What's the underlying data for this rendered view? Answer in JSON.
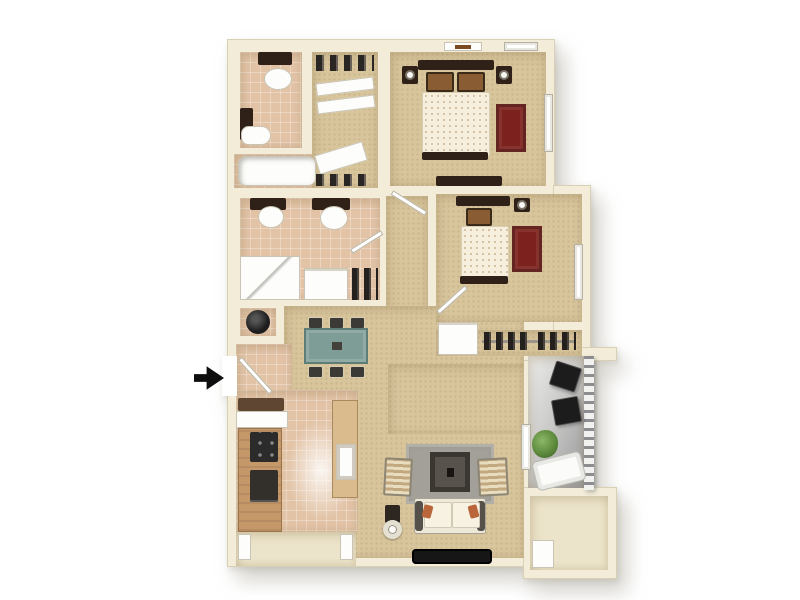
{
  "figure": {
    "kind": "3d-floorplan-rendering",
    "entry_indicator": "black-right-arrow-icon",
    "background": "#ffffff"
  },
  "colors": {
    "wall": "#f2ecd8",
    "wall-edge": "#d8d0b4",
    "carpet": "#d8c59c",
    "tile": "#e2c3a6",
    "cream-floor": "#ece4ca",
    "patio-light": "#ededeb",
    "patio-dark": "#98989a",
    "wood": "#c5986a",
    "wood-light": "#d9bb8e",
    "dark-furn": "#2f2018",
    "appliance-dark": "#2b2b2b",
    "red-rug": "#7c211d",
    "teal-table": "#7e9d96",
    "gray-rug": "#a3a09a",
    "couch-cream": "#eee8d8",
    "comforter": "#f6efdd",
    "pillow-brown": "#8a5c34",
    "plant-green": "#5d8a3c",
    "arrow-black": "#0e0e0e"
  },
  "rooms": [
    {
      "name": "bathroom-1",
      "furniture": [
        "mirror-cabinet",
        "sink",
        "vanity-cabinet",
        "toilet",
        "bathtub"
      ]
    },
    {
      "name": "walk-in-closet-top",
      "furniture": [
        "shelving",
        "sliding-doors"
      ]
    },
    {
      "name": "bedroom-1",
      "furniture": [
        "double-bed",
        "nightstand-left",
        "nightstand-right",
        "lamps",
        "red-rug",
        "dresser",
        "wall-art",
        "windows"
      ]
    },
    {
      "name": "bathroom-2",
      "furniture": [
        "toilet",
        "pedestal-sink",
        "shower",
        "linen-shelf",
        "closet-shelf"
      ]
    },
    {
      "name": "utility-closet",
      "furniture": [
        "water-heater"
      ]
    },
    {
      "name": "hallway",
      "furniture": []
    },
    {
      "name": "bedroom-2",
      "furniture": [
        "bed",
        "nightstand",
        "lamp",
        "red-rug",
        "window",
        "closet-with-hanging-clothes",
        "linen-cabinet"
      ]
    },
    {
      "name": "dining-area",
      "furniture": [
        "dining-table",
        "six-chairs"
      ]
    },
    {
      "name": "kitchen",
      "furniture": [
        "counter-nook",
        "cabinets",
        "stove",
        "refrigerator",
        "island-with-sink"
      ]
    },
    {
      "name": "living-room",
      "furniture": [
        "gray-area-rug",
        "coffee-table",
        "sofa",
        "armchair-left",
        "armchair-right",
        "side-table-ring",
        "console",
        "tv"
      ]
    },
    {
      "name": "balcony",
      "furniture": [
        "patio-chair-1",
        "patio-chair-2",
        "plant",
        "bench",
        "railing",
        "sliding-door"
      ]
    },
    {
      "name": "storage-room",
      "furniture": [
        "storage-box"
      ]
    },
    {
      "name": "entry-porch",
      "furniture": [
        "pillars"
      ]
    }
  ]
}
